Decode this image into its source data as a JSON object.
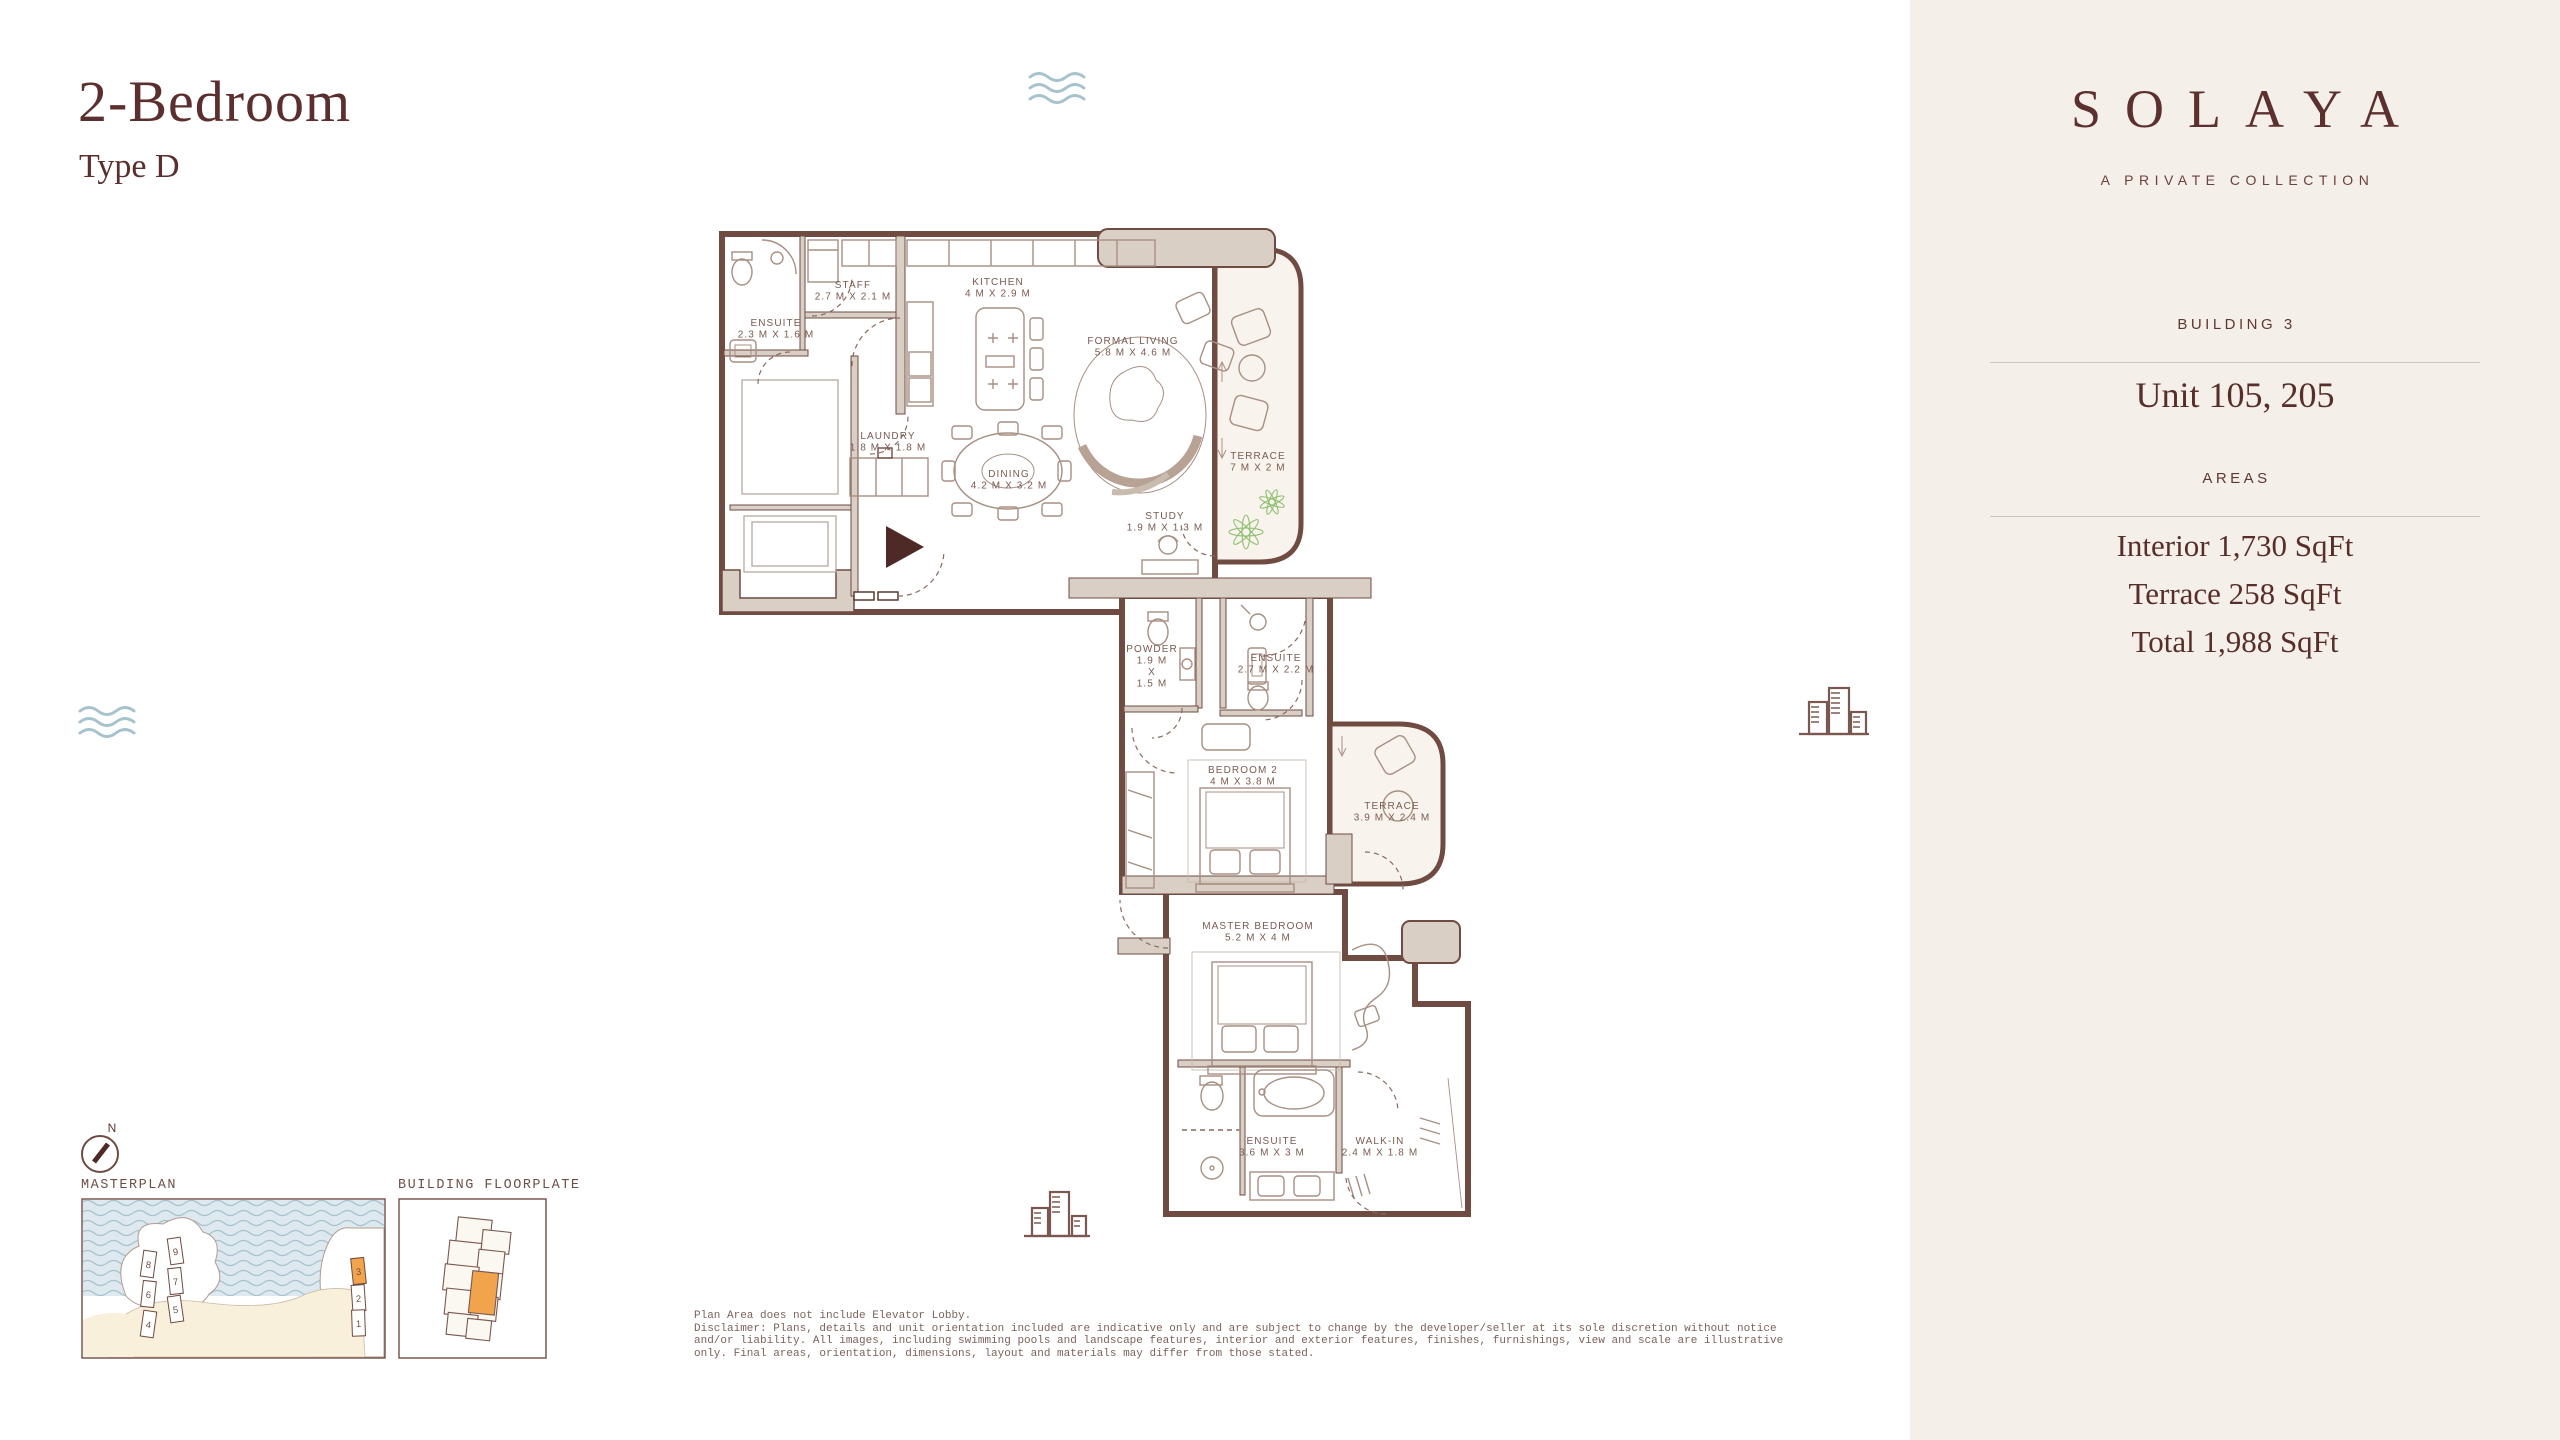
{
  "page": {
    "title": "2-Bedroom",
    "subtitle": "Type D"
  },
  "sidebar": {
    "brand": "SOLAYA",
    "brand_tagline": "A PRIVATE COLLECTION",
    "building_label": "BUILDING 3",
    "unit_label": "Unit 105, 205",
    "areas_label": "AREAS",
    "area_interior": "Interior 1,730 SqFt",
    "area_terrace": "Terrace 258 SqFt",
    "area_total": "Total 1,988 SqFt",
    "logos": {
      "meraas": "MERAAS",
      "brookfield_line1": "Brookfield",
      "brookfield_line2": "Properties"
    }
  },
  "floorplan": {
    "rooms": [
      {
        "id": "staff",
        "label": "STAFF",
        "dims": "2.7 M X 2.1 M",
        "x": 853,
        "y": 288
      },
      {
        "id": "ensuite-staff",
        "label": "ENSUITE",
        "dims": "2.3 M X 1.6 M",
        "x": 776,
        "y": 326
      },
      {
        "id": "kitchen",
        "label": "KITCHEN",
        "dims": "4 M X 2.9 M",
        "x": 998,
        "y": 285
      },
      {
        "id": "formal-living",
        "label": "FORMAL LIVING",
        "dims": "5.8 M X 4.6 M",
        "x": 1133,
        "y": 344
      },
      {
        "id": "laundry",
        "label": "LAUNDRY",
        "dims": "1.8 M X 1.8 M",
        "x": 888,
        "y": 439
      },
      {
        "id": "dining",
        "label": "DINING",
        "dims": "4.2 M X 3.2 M",
        "x": 1009,
        "y": 477
      },
      {
        "id": "terrace-1",
        "label": "TERRACE",
        "dims": "7 M X 2 M",
        "x": 1258,
        "y": 459
      },
      {
        "id": "study",
        "label": "STUDY",
        "dims": "1.9 M X 1.3 M",
        "x": 1165,
        "y": 519
      },
      {
        "id": "powder",
        "lines": [
          "POWDER",
          "1.9 M",
          "X",
          "1.5 M"
        ],
        "x": 1152,
        "y": 652
      },
      {
        "id": "ensuite-2",
        "label": "ENSUITE",
        "dims": "2.7 M X 2.2 M",
        "x": 1276,
        "y": 661
      },
      {
        "id": "bedroom-2",
        "label": "BEDROOM 2",
        "dims": "4 M X 3.8 M",
        "x": 1243,
        "y": 773
      },
      {
        "id": "terrace-2",
        "label": "TERRACE",
        "dims": "3.9 M X 2.4 M",
        "x": 1392,
        "y": 809
      },
      {
        "id": "master-bedroom",
        "label": "MASTER BEDROOM",
        "dims": "5.2 M X 4 M",
        "x": 1258,
        "y": 929
      },
      {
        "id": "ensuite-master",
        "label": "ENSUITE",
        "dims": "3.6 M X 3 M",
        "x": 1272,
        "y": 1144
      },
      {
        "id": "walk-in",
        "label": "WALK-IN",
        "dims": "2.4 M X 1.8 M",
        "x": 1380,
        "y": 1144
      }
    ]
  },
  "minimaps": {
    "compass_n": "N",
    "masterplan_label": "MASTERPLAN",
    "floorplate_label": "BUILDING FLOORPLATE",
    "highlighted_building": "3",
    "masterplan_buildings": [
      {
        "n": "9",
        "x": 88,
        "y": 40,
        "r": -8,
        "hl": false
      },
      {
        "n": "8",
        "x": 61,
        "y": 53,
        "r": 8,
        "hl": false
      },
      {
        "n": "7",
        "x": 88,
        "y": 70,
        "r": -6,
        "hl": false
      },
      {
        "n": "6",
        "x": 61,
        "y": 83,
        "r": 6,
        "hl": false
      },
      {
        "n": "5",
        "x": 88,
        "y": 98,
        "r": -8,
        "hl": false
      },
      {
        "n": "4",
        "x": 61,
        "y": 113,
        "r": 8,
        "hl": false
      },
      {
        "n": "3",
        "x": 271,
        "y": 60,
        "r": -6,
        "hl": true
      },
      {
        "n": "2",
        "x": 271,
        "y": 87,
        "r": -4,
        "hl": false
      },
      {
        "n": "1",
        "x": 271,
        "y": 112,
        "r": -2,
        "hl": false
      }
    ]
  },
  "disclaimer": {
    "lines": [
      "Plan Area does not include Elevator Lobby.",
      "Disclaimer: Plans, details and unit orientation included are indicative only and are subject to change by the developer/seller at its sole discretion without notice",
      "and/or liability. All images, including swimming pools and landscape features, interior and exterior features, finishes, furnishings, view and scale are illustrative",
      "only. Final areas, orientation, dimensions, layout and materials may differ from those stated."
    ]
  },
  "colors": {
    "maroon": "#5b2f2d",
    "wall": "#6f4b42",
    "wall_fill": "#d9cfc5",
    "terrace_fill": "#f8f4ed",
    "sidebar_bg": "#f4efe8",
    "accent_orange": "#f1a44c",
    "water": "#dde9ee",
    "wave": "#a5c2cd",
    "sand": "#f8f0da",
    "plant": "#8fbe71"
  }
}
